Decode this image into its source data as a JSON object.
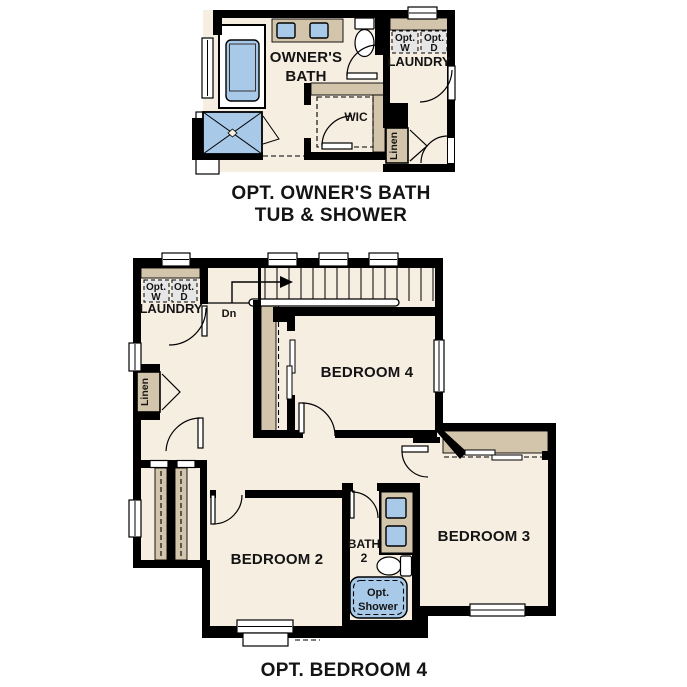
{
  "colors": {
    "background": "#ffffff",
    "floor": "#f6eee1",
    "wall": "#000000",
    "counter_tan": "#d2c5ab",
    "fixture_blue": "#a9c9e8",
    "appliance_gray": "#e6e6e6",
    "text": "#141414"
  },
  "top_plan": {
    "caption_line1": "OPT. OWNER'S BATH",
    "caption_line2": "TUB & SHOWER",
    "owners_bath_line1": "OWNER'S",
    "owners_bath_line2": "BATH",
    "laundry": "LAUNDRY",
    "opt_w_line1": "Opt.",
    "opt_w_line2": "W",
    "opt_d_line1": "Opt.",
    "opt_d_line2": "D",
    "wic": "WIC",
    "linen": "Linen"
  },
  "bottom_plan": {
    "caption": "OPT. BEDROOM 4",
    "laundry": "LAUNDRY",
    "opt_w_line1": "Opt.",
    "opt_w_line2": "W",
    "opt_d_line1": "Opt.",
    "opt_d_line2": "D",
    "linen": "Linen",
    "down_label": "Dn",
    "bedroom4": "BEDROOM 4",
    "bedroom2": "BEDROOM 2",
    "bedroom3": "BEDROOM 3",
    "bath_line1": "BATH",
    "bath_line2": "2",
    "opt_shower_line1": "Opt.",
    "opt_shower_line2": "Shower"
  }
}
